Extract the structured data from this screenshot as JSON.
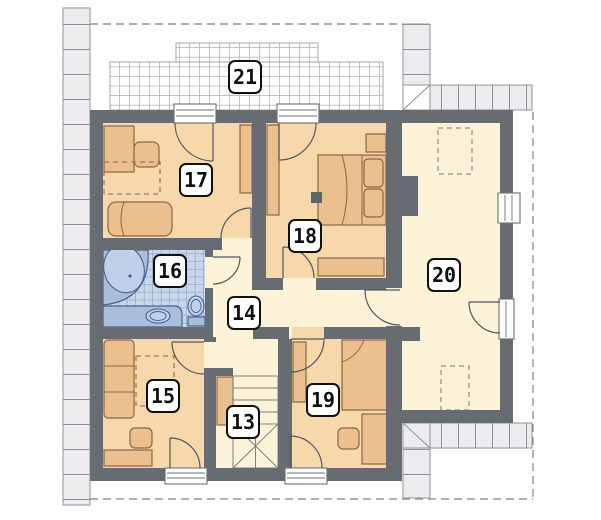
{
  "plan": {
    "type": "architectural-floor-plan",
    "rooms": {
      "r13": {
        "label": "13",
        "kind": "staircase"
      },
      "r14": {
        "label": "14",
        "kind": "hallway"
      },
      "r15": {
        "label": "15",
        "kind": "room"
      },
      "r16": {
        "label": "16",
        "kind": "bathroom"
      },
      "r17": {
        "label": "17",
        "kind": "room"
      },
      "r18": {
        "label": "18",
        "kind": "bedroom"
      },
      "r19": {
        "label": "19",
        "kind": "room"
      },
      "r20": {
        "label": "20",
        "kind": "attic-room"
      },
      "r21": {
        "label": "21",
        "kind": "terrace"
      }
    }
  },
  "colors": {
    "wall": "#676c72",
    "bedroom_floor": "#f6d8ab",
    "hall_floor": "#fcf2d7",
    "bath_tile": "#c9d6e9",
    "furniture": "#ecbf8e",
    "fixture_blue": "#a9bedb",
    "roof_band": "#ececef"
  }
}
